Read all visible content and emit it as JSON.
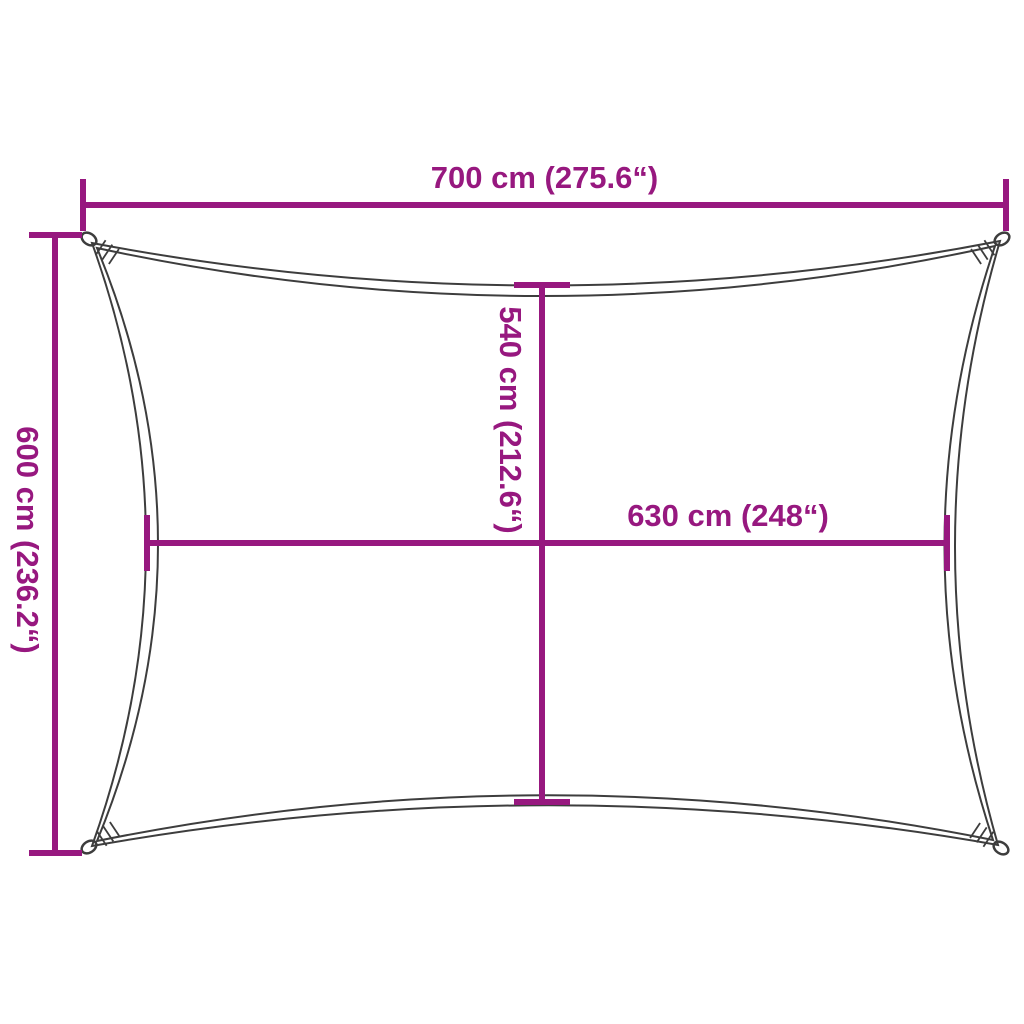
{
  "diagram": {
    "title": "shade-sail-dimension-diagram",
    "background_color": "#ffffff",
    "accent_color": "#97187f",
    "outline_color": "#3d3d3d",
    "labels": {
      "width_top": "700 cm (275.6“)",
      "height_left": "600 cm (236.2“)",
      "inner_height": "540 cm (212.6“)",
      "inner_width": "630 cm (248“)"
    }
  }
}
